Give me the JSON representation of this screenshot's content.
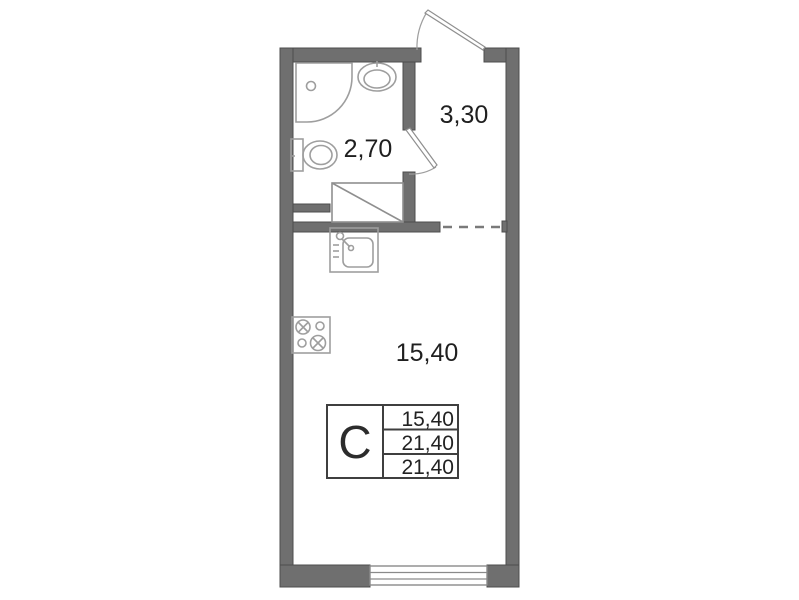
{
  "plan": {
    "name": "studio-apartment-floor-plan",
    "rooms": [
      {
        "id": "bathroom",
        "area_label": "2,70"
      },
      {
        "id": "hallway",
        "area_label": "3,30"
      },
      {
        "id": "living-room",
        "area_label": "15,40"
      }
    ],
    "info_table": {
      "type_label": "С",
      "rows": [
        "15,40",
        "21,40",
        "21,40"
      ]
    },
    "fixtures": [
      "shower-tray",
      "washbasin",
      "toilet",
      "vent-shaft",
      "kitchen-sink",
      "stove",
      "window",
      "entrance-door",
      "bathroom-door"
    ],
    "colors": {
      "wall": "#6f6f6f",
      "wall_edge": "#4c4c4c",
      "fixture_line": "#9e9e9e",
      "dashed_line": "#7a7a7a",
      "text": "#1f1f1f",
      "table_border": "#3f3f3f"
    }
  }
}
